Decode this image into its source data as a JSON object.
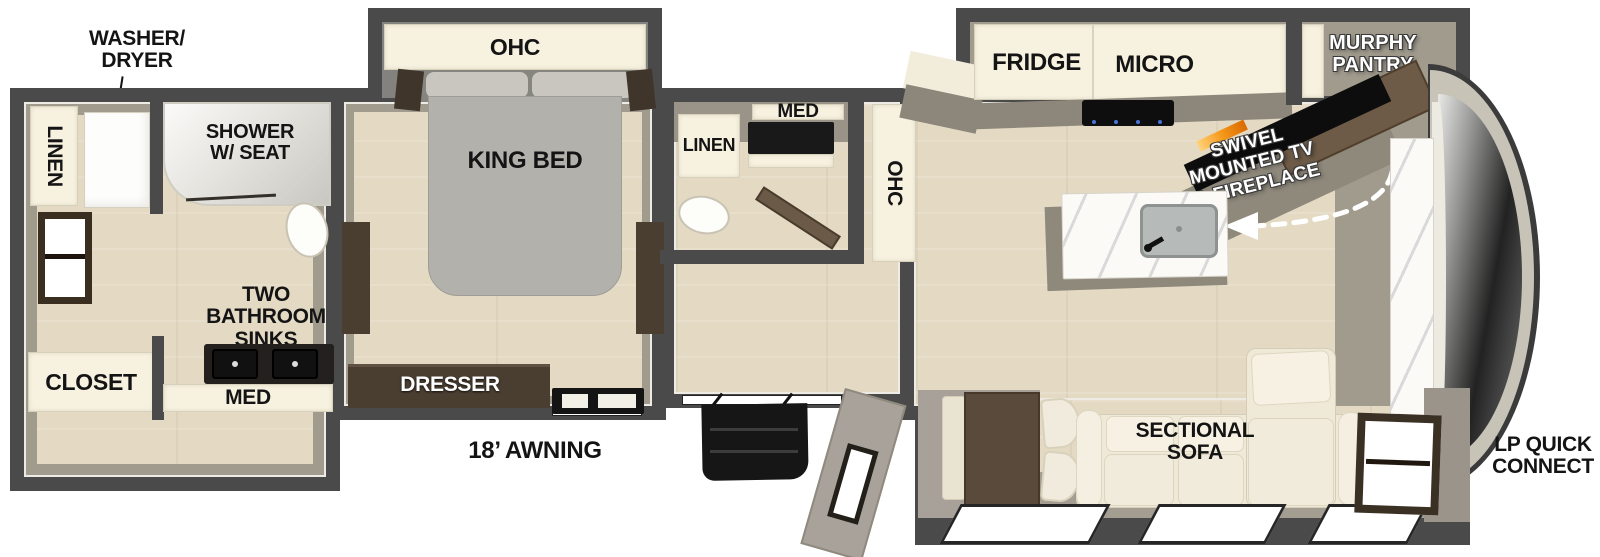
{
  "colors": {
    "wall": "#4a4a4a",
    "floor_wood": "#e4dac4",
    "interior_taupe": "#a19b8e",
    "cabinet_cream": "#f7f1df",
    "furniture_dark_wood": "#4a3e31",
    "furniture_mid_wood": "#6e5b47",
    "fixture_black": "#141414",
    "bed_gray": "#b3b1ab",
    "flame_orange": "#f59a1c",
    "label_black": "#141414",
    "label_white": "#ffffff"
  },
  "exterior": {
    "washer_dryer": [
      "WASHER/",
      "DRYER"
    ],
    "awning": "18’ AWNING",
    "lp_quick_connect": [
      "LP QUICK",
      "CONNECT"
    ]
  },
  "rear_bath": {
    "linen": "LINEN",
    "shower": [
      "SHOWER",
      "W/ SEAT"
    ],
    "closet": "CLOSET",
    "sinks": [
      "TWO",
      "BATHROOM",
      "SINKS"
    ],
    "med": "MED"
  },
  "bedroom": {
    "ohc": "OHC",
    "king_bed": "KING BED",
    "dresser": "DRESSER"
  },
  "mid_bath": {
    "linen": "LINEN",
    "med": "MED"
  },
  "kitchen": {
    "ohc": "OHC",
    "fridge": "FRIDGE",
    "micro": "MICRO",
    "murphy_pantry": [
      "MURPHY",
      "PANTRY"
    ],
    "swivel_tv": [
      "SWIVEL",
      "MOUNTED TV",
      "& FIREPLACE"
    ]
  },
  "living": {
    "sectional_sofa": [
      "SECTIONAL",
      "SOFA"
    ]
  }
}
